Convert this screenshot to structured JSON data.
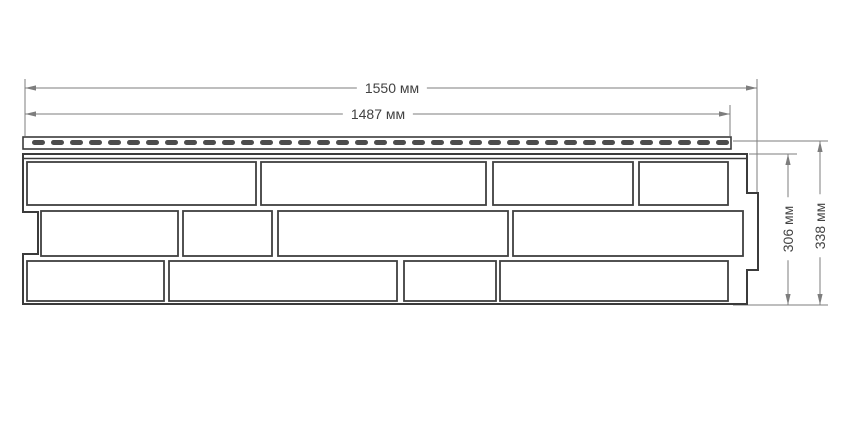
{
  "drawing": {
    "subject": "facade-panel-dimension-drawing",
    "unit": "мм",
    "dimensions": {
      "total_width": {
        "label": "1550 мм",
        "value": 1550
      },
      "nail_strip_width": {
        "label": "1487 мм",
        "value": 1487
      },
      "panel_height": {
        "label": "306 мм",
        "value": 306
      },
      "total_height": {
        "label": "338 мм",
        "value": 338
      }
    },
    "colors": {
      "background": "#ffffff",
      "panel_line": "#3b3b3b",
      "brick_line": "#3f3f3f",
      "slot_fill": "#4c4c4c",
      "dimension_line": "#7d7d7d",
      "text": "#424242"
    },
    "geometry": {
      "canvas": {
        "w": 850,
        "h": 425
      },
      "nail_strip": {
        "x": 23,
        "y": 137,
        "w": 708,
        "h": 12
      },
      "slots": {
        "x0": 32,
        "y": 140,
        "w": 13,
        "h": 5,
        "pitch": 19,
        "count": 37,
        "rx": 2.5
      },
      "outline_path": "M 23 154 L 747 154 L 747 193 L 758 193 L 758 270 L 747 270 L 747 304 L 23 304 L 23 254 L 38 254 L 38 212 L 23 212 Z",
      "inner_top_line": {
        "x1": 23,
        "y1": 158.5,
        "x2": 747,
        "y2": 158.5
      },
      "brick_rows": [
        {
          "y": 162,
          "h": 43,
          "bricks": [
            [
              27,
              256
            ],
            [
              261,
              486
            ],
            [
              493,
              633
            ],
            [
              639,
              728
            ]
          ]
        },
        {
          "y": 211,
          "h": 45,
          "bricks": [
            [
              41,
              178
            ],
            [
              183,
              272
            ],
            [
              278,
              508
            ],
            [
              513,
              743
            ]
          ]
        },
        {
          "y": 261,
          "h": 40,
          "bricks": [
            [
              27,
              164
            ],
            [
              169,
              397
            ],
            [
              404,
              496
            ],
            [
              500,
              728
            ]
          ]
        }
      ],
      "dim_lines": [
        {
          "id": "total-width",
          "orient": "h",
          "pos": 88,
          "from": 25,
          "to": 757
        },
        {
          "id": "nail-width",
          "orient": "h",
          "pos": 114,
          "from": 25,
          "to": 730
        },
        {
          "id": "panel-height",
          "orient": "v",
          "pos": 788,
          "from": 154,
          "to": 305
        },
        {
          "id": "total-height",
          "orient": "v",
          "pos": 820,
          "from": 141,
          "to": 305
        }
      ],
      "extension_lines": [
        {
          "x1": 25,
          "y1": 79,
          "x2": 25,
          "y2": 136
        },
        {
          "x1": 757,
          "y1": 79,
          "x2": 757,
          "y2": 192
        },
        {
          "x1": 730,
          "y1": 105,
          "x2": 730,
          "y2": 136
        },
        {
          "x1": 749,
          "y1": 154,
          "x2": 797,
          "y2": 154
        },
        {
          "x1": 733,
          "y1": 141,
          "x2": 828,
          "y2": 141
        },
        {
          "x1": 733,
          "y1": 305,
          "x2": 828,
          "y2": 305
        }
      ],
      "label_anchors": [
        {
          "key": "total_width",
          "x": 392,
          "y": 88,
          "rotated": false
        },
        {
          "key": "nail_strip_width",
          "x": 378,
          "y": 114,
          "rotated": false
        },
        {
          "key": "panel_height",
          "x": 788,
          "y": 229,
          "rotated": true
        },
        {
          "key": "total_height",
          "x": 820,
          "y": 226,
          "rotated": true
        }
      ]
    }
  }
}
